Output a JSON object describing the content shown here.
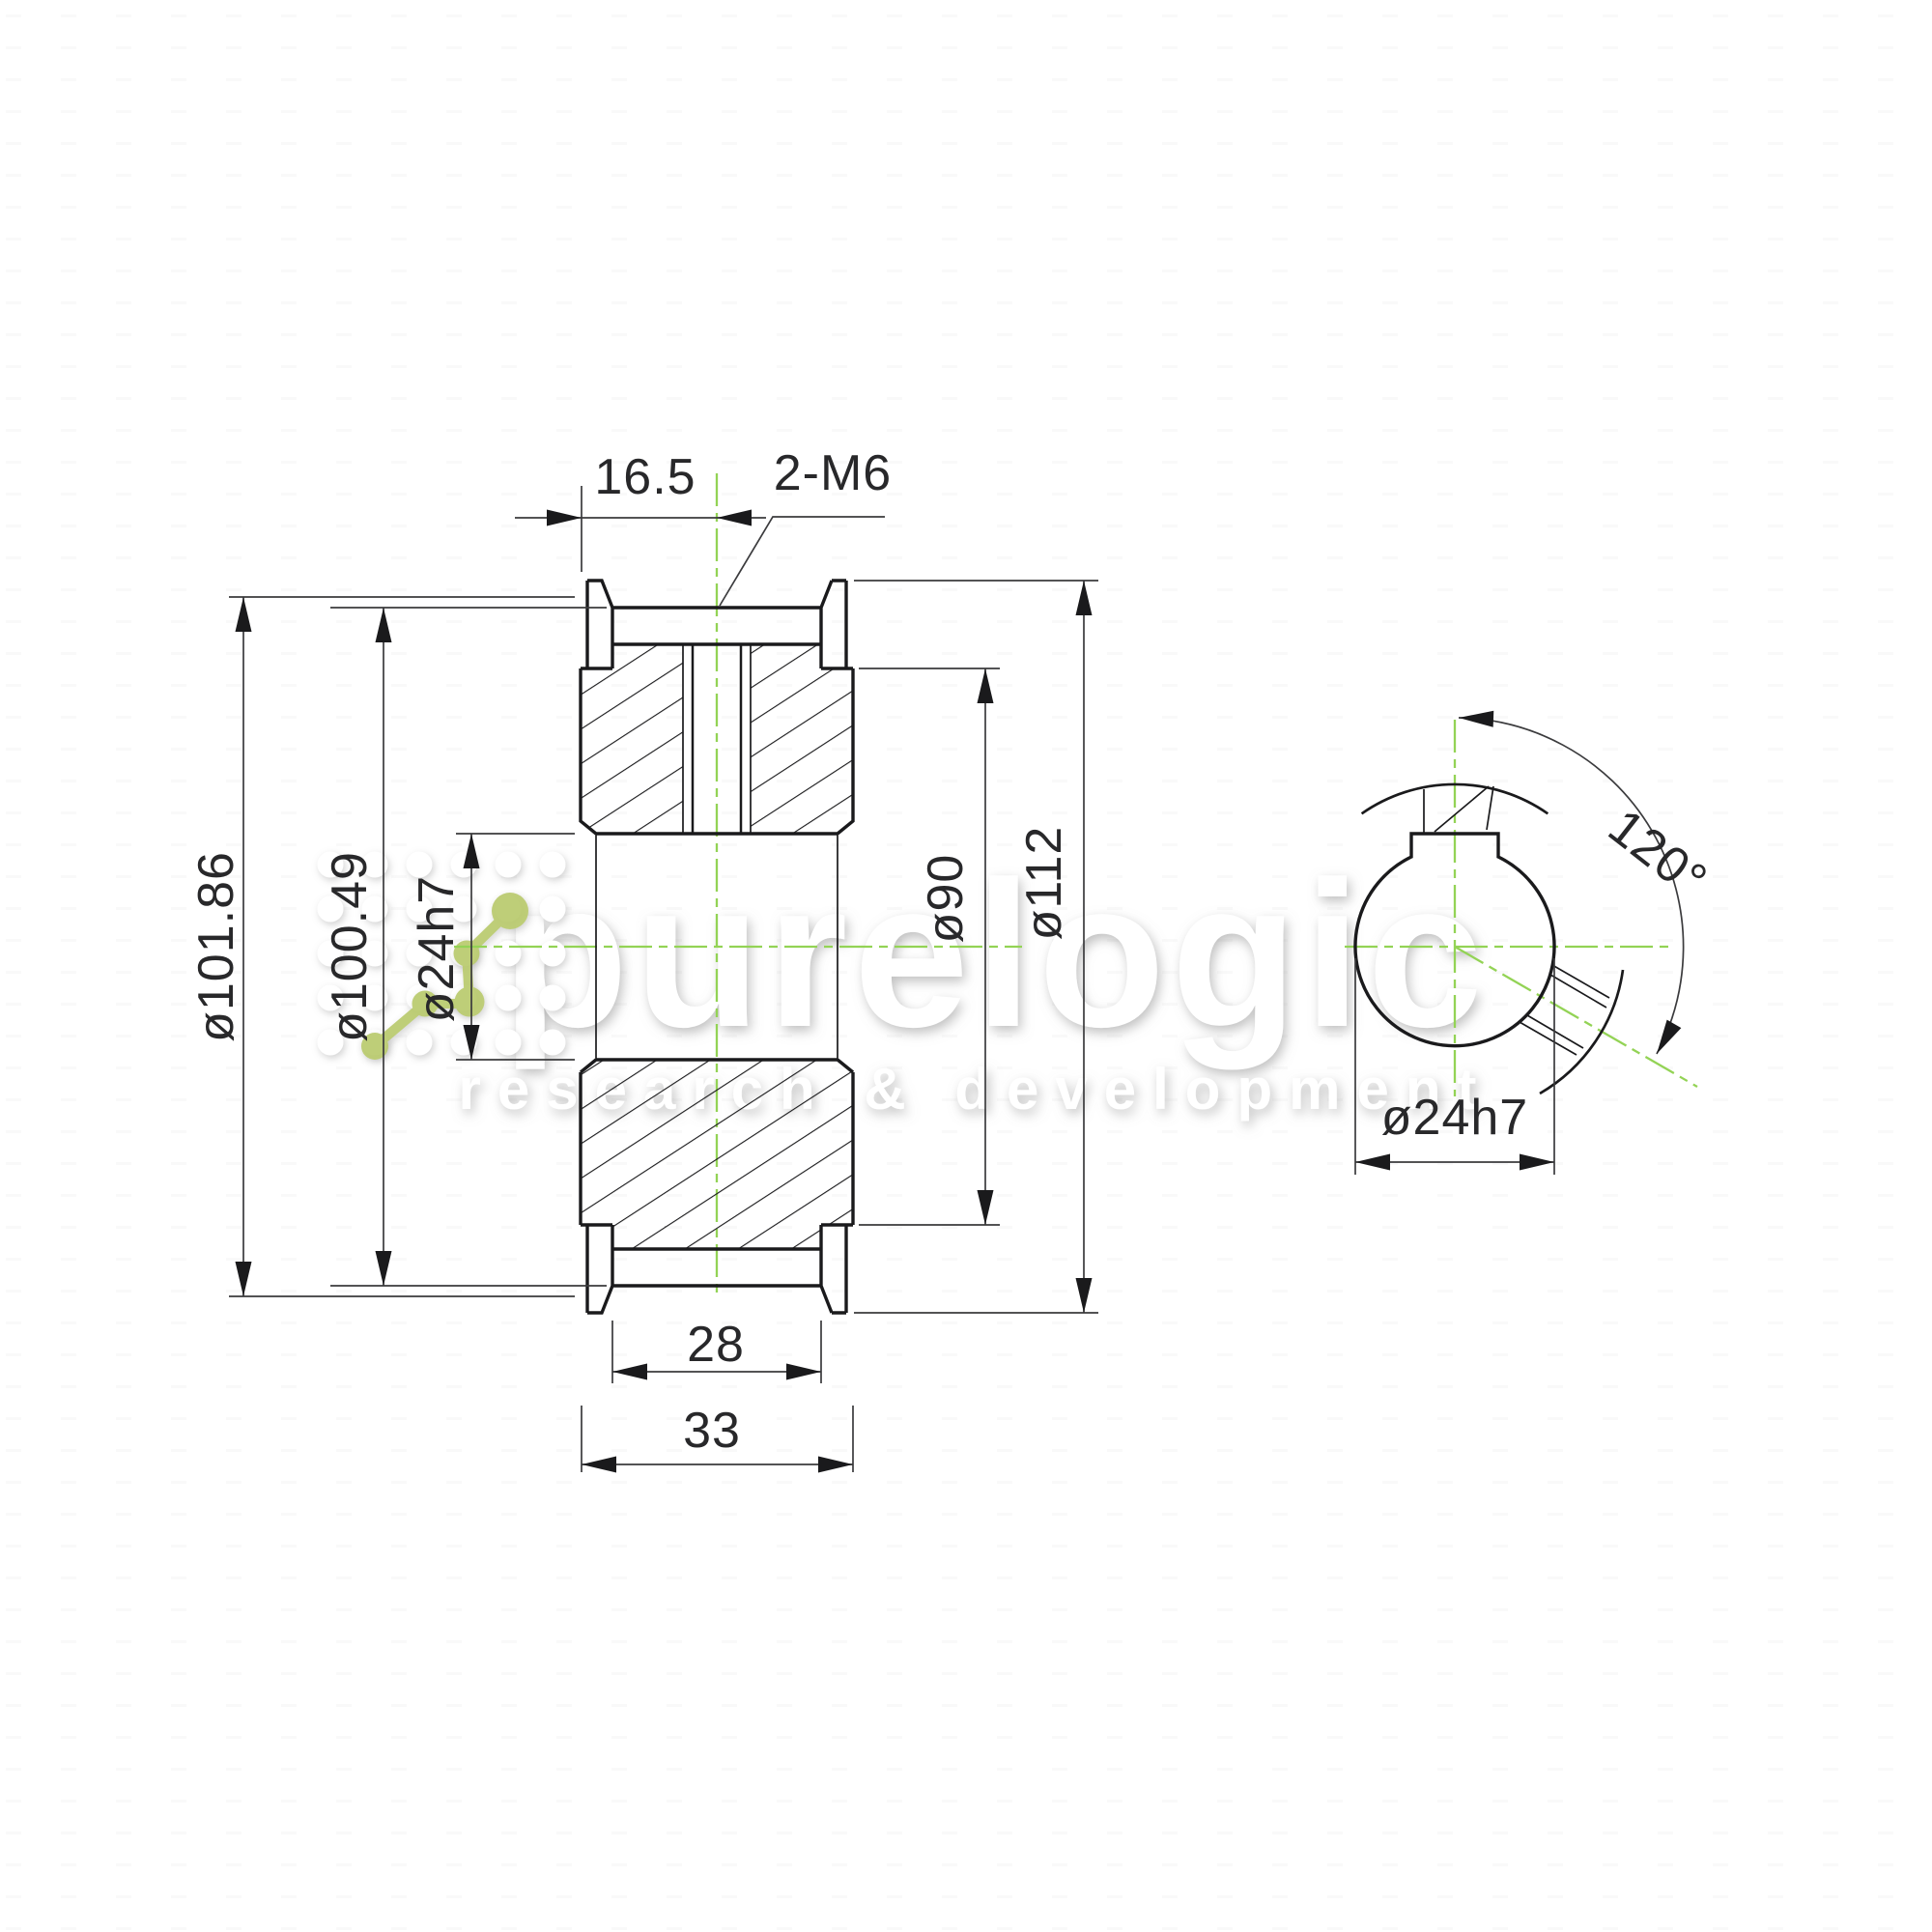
{
  "front_view": {
    "dims": {
      "offset_16_5": "16.5",
      "thread_callout": "2-M6",
      "dia_101_86": "ø101.86",
      "dia_100_49": "ø100.49",
      "dia_24h7": "ø24h7",
      "dia_90": "ø90",
      "dia_112": "ø112",
      "width_28": "28",
      "width_33": "33"
    }
  },
  "side_view": {
    "dims": {
      "dia_24h7": "ø24h7",
      "angle_120": "120°"
    }
  },
  "watermark": {
    "brand": "purelogic",
    "tagline": "research & development"
  },
  "colors": {
    "outline": "#1a1a1c",
    "dimension": "#3b3b3d",
    "centerline": "#93d355",
    "logo_green": "#b9ca6d",
    "background": "#ffffff"
  }
}
